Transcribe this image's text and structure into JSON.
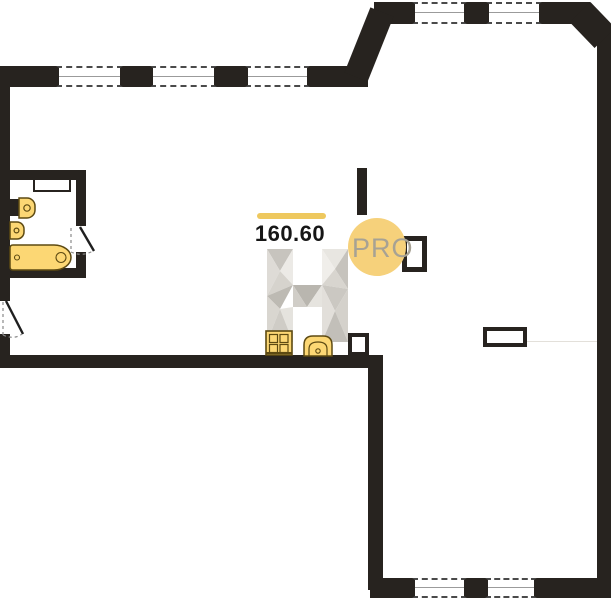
{
  "plan": {
    "area_label": "160.60",
    "badge_label": "PRO",
    "watermark_letter": "H",
    "colors": {
      "wall": "#27231f",
      "accent_line": "#eec85e",
      "badge_bg": "#f6d17b",
      "badge_text": "#a7a294",
      "fixture_fill": "#fcd774",
      "fixture_stroke": "#5d4a12",
      "window_dash": "#4a4a4a",
      "door_dash": "#8a8a8a"
    },
    "fixtures": [
      {
        "name": "washbasin-icon"
      },
      {
        "name": "toilet-icon"
      },
      {
        "name": "bathtub-icon"
      },
      {
        "name": "stove-icon"
      },
      {
        "name": "kitchen-sink-icon"
      },
      {
        "name": "shaft-icon"
      },
      {
        "name": "column-icon"
      },
      {
        "name": "door-swing-icon"
      }
    ]
  }
}
